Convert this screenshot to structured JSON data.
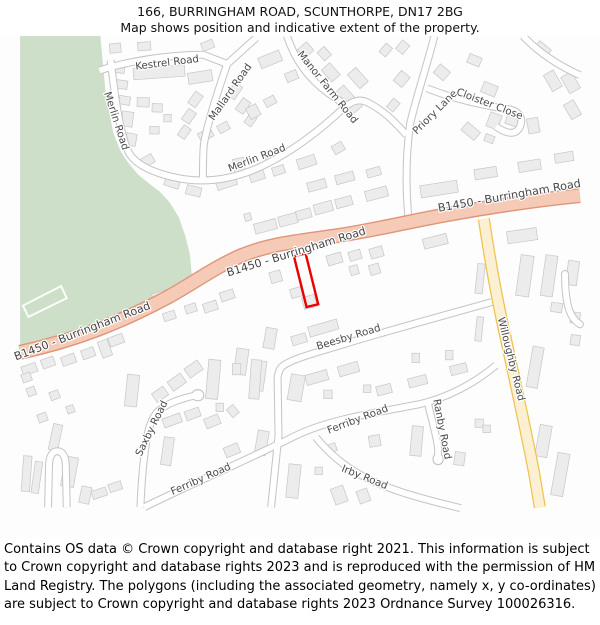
{
  "header": {
    "title_line1": "166, BURRINGHAM ROAD, SCUNTHORPE, DN17 2BG",
    "title_line2": "Map shows position and indicative extent of the property."
  },
  "attribution": "Contains OS data © Crown copyright and database right 2021. This information is subject to Crown copyright and database rights 2023 and is reproduced with the permission of HM Land Registry. The polygons (including the associated geometry, namely x, y co-ordinates) are subject to Crown copyright and database rights 2023 Ordnance Survey 100026316.",
  "map": {
    "road_labels": {
      "kestrel": "Kestrel Road",
      "merlin_v": "Merlin Road",
      "mallard": "Mallard Road",
      "merlin_h": "Merlin Road",
      "manor_farm": "Manor Farm Road",
      "priory": "Priory Lane",
      "cloister": "Cloister Close",
      "b1450_left": "B1450 - Burringham Road",
      "b1450_mid": "B1450 - Burringham Road",
      "b1450_right": "B1450 - Burringham Road",
      "willoughby": "Willoughby Road",
      "beesby": "Beesby Road",
      "saxby": "Saxby Road",
      "ferriby_w": "Ferriby Road",
      "ferriby_e": "Ferriby Road",
      "ranby": "Ranby Road",
      "irby": "Irby Road"
    },
    "colors": {
      "green_area": "#cddfc8",
      "building_fill": "#ececec",
      "building_stroke": "#c9c9c9",
      "minor_road_casing": "#c5c5c5",
      "minor_road_fill": "#ffffff",
      "primary_road_casing": "#e09478",
      "primary_road_fill": "#f5cbb8",
      "secondary_road_casing": "#efc24f",
      "secondary_road_fill": "#fbf1d2",
      "highlight": "#ec0000",
      "field_outline": "#ffffff"
    },
    "property_highlight": {
      "points": "293.5,272 306,269 319.5,323.5 307,326.5",
      "stroke_width": 2.6
    },
    "buildings": [
      [
        149,
        75,
        55,
        12,
        -4
      ],
      [
        193,
        80,
        26,
        12,
        -9
      ],
      [
        102,
        49,
        12,
        10,
        -6
      ],
      [
        133,
        47,
        14,
        9,
        -4
      ],
      [
        201,
        46,
        13,
        9,
        -22
      ],
      [
        106,
        71,
        12,
        9,
        6
      ],
      [
        109,
        88,
        12,
        9,
        8
      ],
      [
        112,
        105,
        12,
        9,
        10
      ],
      [
        115,
        125,
        12,
        16,
        8
      ],
      [
        119,
        147,
        11,
        13,
        10
      ],
      [
        132,
        107,
        13,
        10,
        2
      ],
      [
        147,
        113,
        11,
        9,
        2
      ],
      [
        158,
        124,
        8,
        8,
        0
      ],
      [
        144,
        137,
        10,
        8,
        0
      ],
      [
        188,
        104,
        15,
        10,
        -55
      ],
      [
        181,
        122,
        14,
        10,
        -55
      ],
      [
        176,
        139,
        13,
        9,
        -55
      ],
      [
        230,
        95,
        16,
        10,
        -55
      ],
      [
        239,
        111,
        15,
        10,
        -55
      ],
      [
        247,
        126,
        12,
        9,
        -55
      ],
      [
        136,
        170,
        15,
        10,
        -30
      ],
      [
        163,
        193,
        16,
        10,
        18
      ],
      [
        186,
        202,
        16,
        10,
        14
      ],
      [
        199,
        142,
        15,
        10,
        -28
      ],
      [
        218,
        134,
        12,
        9,
        -28
      ],
      [
        250,
        117,
        12,
        13,
        -28
      ],
      [
        268,
        106,
        12,
        9,
        -28
      ],
      [
        268,
        61,
        24,
        12,
        -22
      ],
      [
        291,
        79,
        13,
        10,
        -22
      ],
      [
        306,
        51,
        12,
        13,
        48
      ],
      [
        326,
        55,
        12,
        10,
        48
      ],
      [
        333,
        75,
        17,
        12,
        48
      ],
      [
        362,
        81,
        20,
        12,
        48
      ],
      [
        352,
        104,
        30,
        13,
        48
      ],
      [
        392,
        51,
        12,
        9,
        -50
      ],
      [
        410,
        48,
        12,
        10,
        -50
      ],
      [
        409,
        82,
        14,
        12,
        -50
      ],
      [
        400,
        110,
        12,
        9,
        -50
      ],
      [
        452,
        75,
        12,
        14,
        -50
      ],
      [
        487,
        62,
        14,
        10,
        22
      ],
      [
        503,
        93,
        16,
        12,
        22
      ],
      [
        508,
        127,
        13,
        16,
        20
      ],
      [
        528,
        126,
        14,
        12,
        20
      ],
      [
        550,
        132,
        12,
        16,
        -10
      ],
      [
        483,
        138,
        11,
        18,
        -50
      ],
      [
        503,
        146,
        10,
        8,
        20
      ],
      [
        571,
        84,
        12,
        20,
        -30
      ],
      [
        590,
        86,
        13,
        20,
        -30
      ],
      [
        592,
        115,
        12,
        18,
        -30
      ],
      [
        560,
        50,
        16,
        10,
        40
      ],
      [
        221,
        193,
        22,
        11,
        -18
      ],
      [
        254,
        186,
        16,
        10,
        -18
      ],
      [
        277,
        180,
        13,
        9,
        -18
      ],
      [
        307,
        171,
        20,
        11,
        -18
      ],
      [
        341,
        156,
        12,
        10,
        -30
      ],
      [
        235,
        176,
        12,
        18,
        -12
      ],
      [
        272,
        163,
        20,
        11,
        -16
      ],
      [
        318,
        196,
        20,
        10,
        -15
      ],
      [
        348,
        188,
        20,
        10,
        -15
      ],
      [
        379,
        182,
        15,
        9,
        -15
      ],
      [
        263,
        240,
        24,
        11,
        -15
      ],
      [
        287,
        233,
        20,
        11,
        -15
      ],
      [
        304,
        227,
        16,
        10,
        -15
      ],
      [
        325,
        220,
        20,
        11,
        -15
      ],
      [
        347,
        214,
        18,
        10,
        -15
      ],
      [
        382,
        205,
        24,
        11,
        -15
      ],
      [
        449,
        200,
        40,
        13,
        -9
      ],
      [
        244,
        230,
        7,
        8,
        -15
      ],
      [
        499,
        183,
        24,
        11,
        -9
      ],
      [
        546,
        175,
        24,
        11,
        -9
      ],
      [
        583,
        166,
        20,
        10,
        -9
      ],
      [
        274,
        294,
        12,
        12,
        -16
      ],
      [
        296,
        311,
        12,
        10,
        -16
      ],
      [
        310,
        321,
        14,
        13,
        -16
      ],
      [
        337,
        275,
        16,
        11,
        -16
      ],
      [
        359,
        271,
        13,
        10,
        -16
      ],
      [
        358,
        287,
        9,
        10,
        -16
      ],
      [
        380,
        286,
        11,
        11,
        -16
      ],
      [
        382,
        268,
        14,
        11,
        -16
      ],
      [
        268,
        360,
        12,
        22,
        10
      ],
      [
        299,
        361,
        16,
        10,
        -16
      ],
      [
        325,
        349,
        32,
        11,
        -16
      ],
      [
        424,
        381,
        8,
        10,
        0
      ],
      [
        460,
        378,
        8,
        10,
        0
      ],
      [
        470,
        393,
        18,
        10,
        -14
      ],
      [
        426,
        406,
        20,
        10,
        -14
      ],
      [
        390,
        415,
        16,
        10,
        -14
      ],
      [
        318,
        402,
        24,
        11,
        -16
      ],
      [
        352,
        393,
        22,
        11,
        -16
      ],
      [
        330,
        420,
        9,
        9,
        0
      ],
      [
        372,
        414,
        8,
        8,
        0
      ],
      [
        296,
        413,
        15,
        28,
        10
      ],
      [
        256,
        400,
        13,
        32,
        8
      ],
      [
        237,
        385,
        13,
        28,
        8
      ],
      [
        445,
        256,
        26,
        11,
        -14
      ],
      [
        10,
        393,
        16,
        10,
        -20
      ],
      [
        30,
        386,
        14,
        10,
        -20
      ],
      [
        52,
        383,
        15,
        10,
        -20
      ],
      [
        73,
        376,
        14,
        10,
        -20
      ],
      [
        91,
        371,
        11,
        18,
        -20
      ],
      [
        103,
        362,
        16,
        10,
        -20
      ],
      [
        7,
        402,
        10,
        9,
        -20
      ],
      [
        37,
        421,
        10,
        9,
        -20
      ],
      [
        54,
        436,
        8,
        8,
        -20
      ],
      [
        24,
        445,
        10,
        9,
        -20
      ],
      [
        12,
        417,
        9,
        9,
        -20
      ],
      [
        150,
        315,
        16,
        10,
        -18
      ],
      [
        172,
        307,
        14,
        10,
        -18
      ],
      [
        204,
        326,
        15,
        10,
        -18
      ],
      [
        222,
        314,
        15,
        10,
        -18
      ],
      [
        160,
        336,
        13,
        9,
        -18
      ],
      [
        183,
        328,
        12,
        9,
        -18
      ],
      [
        120,
        416,
        13,
        34,
        6
      ],
      [
        150,
        420,
        15,
        11,
        -35
      ],
      [
        168,
        407,
        17,
        12,
        -35
      ],
      [
        186,
        393,
        17,
        12,
        -35
      ],
      [
        207,
        404,
        13,
        42,
        5
      ],
      [
        232,
        393,
        9,
        12,
        0
      ],
      [
        252,
        404,
        11,
        42,
        4
      ],
      [
        214,
        434,
        8,
        9,
        0
      ],
      [
        163,
        448,
        20,
        10,
        -20
      ],
      [
        185,
        441,
        16,
        10,
        -20
      ],
      [
        228,
        438,
        9,
        11,
        -40
      ],
      [
        7,
        505,
        9,
        38,
        4
      ],
      [
        18,
        509,
        8,
        34,
        8
      ],
      [
        38,
        466,
        10,
        28,
        12
      ],
      [
        53,
        503,
        14,
        32,
        10
      ],
      [
        70,
        528,
        11,
        18,
        12
      ],
      [
        85,
        526,
        16,
        9,
        -18
      ],
      [
        102,
        519,
        14,
        9,
        -18
      ],
      [
        158,
        481,
        11,
        30,
        8
      ],
      [
        206,
        449,
        16,
        11,
        -22
      ],
      [
        227,
        480,
        16,
        11,
        -22
      ],
      [
        259,
        472,
        12,
        26,
        10
      ],
      [
        293,
        513,
        13,
        36,
        6
      ],
      [
        320,
        502,
        8,
        8,
        0
      ],
      [
        342,
        528,
        14,
        18,
        -20
      ],
      [
        368,
        529,
        12,
        14,
        -20
      ],
      [
        333,
        478,
        12,
        9,
        -20
      ],
      [
        380,
        470,
        12,
        12,
        -10
      ],
      [
        425,
        470,
        12,
        32,
        5
      ],
      [
        471,
        489,
        11,
        14,
        8
      ],
      [
        492,
        451,
        9,
        9,
        0
      ],
      [
        500,
        457,
        8,
        8,
        0
      ],
      [
        538,
        250,
        32,
        13,
        -8
      ],
      [
        541,
        293,
        14,
        44,
        8
      ],
      [
        567,
        293,
        13,
        44,
        8
      ],
      [
        592,
        290,
        12,
        26,
        8
      ],
      [
        575,
        327,
        12,
        10,
        8
      ],
      [
        595,
        338,
        10,
        12,
        8
      ],
      [
        552,
        391,
        12,
        44,
        10
      ],
      [
        595,
        362,
        10,
        11,
        8
      ],
      [
        561,
        470,
        13,
        34,
        10
      ],
      [
        579,
        506,
        13,
        46,
        10
      ],
      [
        493,
        296,
        8,
        32,
        6
      ],
      [
        492,
        350,
        7,
        26,
        6
      ]
    ]
  }
}
